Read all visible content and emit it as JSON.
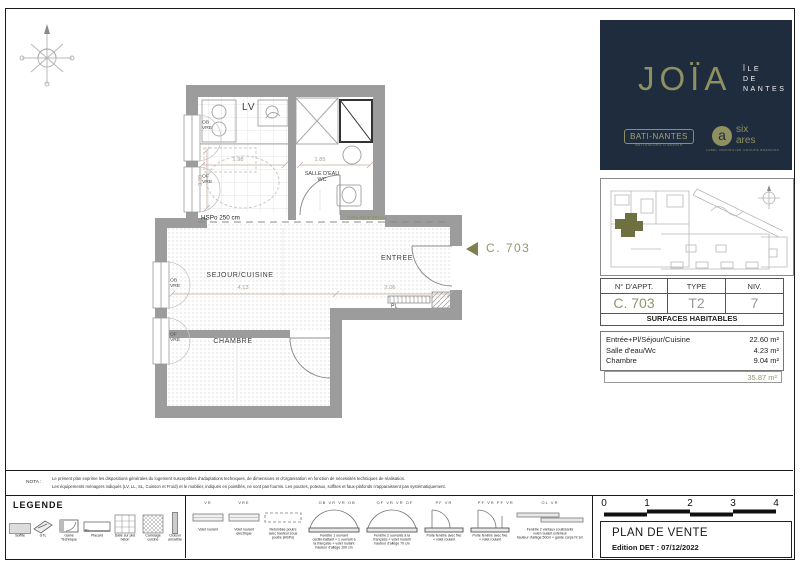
{
  "colors": {
    "navy": "#1e2c3d",
    "olive": "#8f9061",
    "wall": "#9c9c9c"
  },
  "brand": {
    "joia": "JOÏA",
    "ile": "ÎLE",
    "de": "DE",
    "nantes": "NANTES",
    "bati_nantes": "BATI-NANTES",
    "bati_tagline": "BÂTISSEURS D'AVENIR",
    "sixares_a": "a",
    "sixares_line1": "six",
    "sixares_line2": "ares",
    "sixares_tagline": "LABEL IMMOBILIER GROUPE BRÉMOND"
  },
  "apartment": {
    "headers": [
      "N° D'APPT.",
      "TYPE",
      "NIV."
    ],
    "number": "C. 703",
    "type": "T2",
    "level": "7"
  },
  "surfaces": {
    "title": "SURFACES HABITABLES",
    "rows": [
      {
        "label": "Entrée+Pl/Séjour/Cuisine",
        "value": "22.60 m²"
      },
      {
        "label": "Salle d'eau/Wc",
        "value": "4.23 m²"
      },
      {
        "label": "Chambre",
        "value": "9.04 m²"
      }
    ],
    "total": "35.87 m²"
  },
  "plan": {
    "marker": {
      "label": "C. 703"
    },
    "rooms": {
      "sejour": "SEJOUR/CUISINE",
      "chambre": "CHAMBRE",
      "entree": "ENTREE",
      "salle_eau_1": "SALLE D'EAU",
      "salle_eau_2": "WC",
      "lv": "LV",
      "pl": "PL"
    },
    "annotations": {
      "hspo": "HSPo 250 cm",
      "coffre": "Coffre HSFP 230 cm"
    },
    "dims": {
      "d1": "1.98",
      "d2": "1.85",
      "d3": "4.13",
      "d4": "2.06",
      "d5": "3.39"
    },
    "windows": [
      {
        "l1": "OB",
        "l2": "VRE"
      },
      {
        "l1": "OF",
        "l2": "VRE"
      },
      {
        "l1": "OB",
        "l2": "VRE"
      },
      {
        "l1": "OF",
        "l2": "VRE"
      }
    ]
  },
  "scale_bar": {
    "ticks": [
      "0",
      "1",
      "2",
      "3",
      "4"
    ]
  },
  "title_block": {
    "title": "PLAN DE VENTE",
    "edition": "Edition DET : 07/12/2022"
  },
  "nota": {
    "label": "NOTA :",
    "line1": "Le présent plan exprime les dispositions générales du logement susceptibles d'adaptations techniques, de dimensions et d'organisation en fonction de nécessités techniques de réalisation.",
    "line2": "Les équipements ménagers indiqués (LV, LL, SL, Cuisson et Froid) et le mobilier, indiqués en pointillés, ne sont pas fournis. Les poutres, poteaux, soffites et faux-plafonds n'apparaissent pas systématiquement."
  },
  "legend": {
    "title": "LEGENDE",
    "items": [
      {
        "label1": "Soffite",
        "label2": ""
      },
      {
        "label1": "GTL",
        "label2": ""
      },
      {
        "label1": "Gaine",
        "label2": "Technique"
      },
      {
        "label1": "Placard",
        "label2": "",
        "icon_text": "PL"
      },
      {
        "label1": "Dalle sur plot",
        "label2": "béton"
      },
      {
        "label1": "Carrelage",
        "label2": "cuisine"
      },
      {
        "label1": "Cloison",
        "label2": "amovible"
      }
    ],
    "symbols": [
      {
        "tag": "VR",
        "lines": [
          "Volet roulant",
          "",
          ""
        ]
      },
      {
        "tag": "VRE",
        "lines": [
          "Volet roulant",
          "électrique",
          ""
        ]
      },
      {
        "tag": "",
        "lines": [
          "Retombée poutre",
          "avec hauteur sous",
          "poutre (HSPo)"
        ]
      },
      {
        "tag": "OB  VR  VR  OB",
        "lines": [
          "Fenêtre 1 ouvrant",
          "oscillo-battant + 1 ouvrant à",
          "la française + volet roulant",
          "hauteur d'allège 100 cm"
        ]
      },
      {
        "tag": "OF  VR  VR  OF",
        "lines": [
          "Fenêtre 2 ouvrants à la",
          "française + volet roulant",
          "hauteur d'allège 70 cm",
          ""
        ]
      },
      {
        "tag": "PF  VR",
        "lines": [
          "Porte fenêtre avec fixe",
          "+ volet roulant",
          ""
        ]
      },
      {
        "tag": "PF  VR  PF  VR",
        "lines": [
          "Porte fenêtre avec fixe",
          "+ volet roulant",
          ""
        ]
      },
      {
        "tag": "OL  VR",
        "lines": [
          "Fenêtre 2 vantaux coulissants",
          "volet roulant extérieur",
          "hauteur d'allège 50cm + garde corps ht 1m"
        ]
      }
    ]
  }
}
